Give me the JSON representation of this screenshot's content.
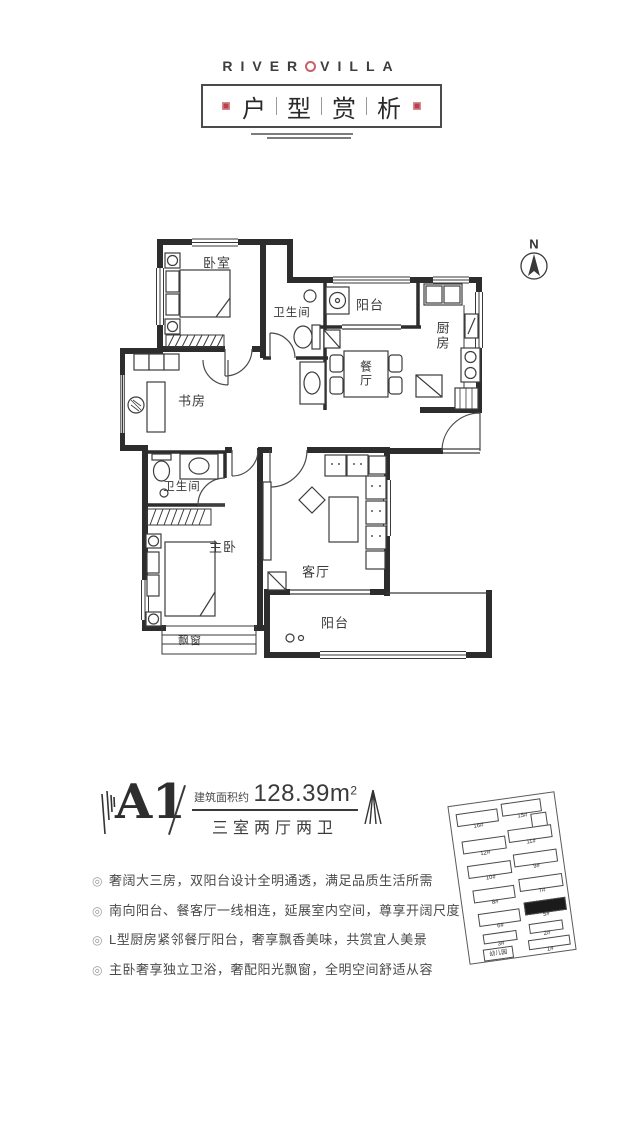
{
  "colors": {
    "accent_red": "#c9606b",
    "seal_red": "#b5434c",
    "wall": "#2d2d2d",
    "text": "#3e3e3e"
  },
  "header": {
    "brand_left": "RIVER",
    "brand_right": "VILLA",
    "title_chars": [
      "户",
      "型",
      "赏",
      "析"
    ]
  },
  "floor_plan": {
    "north_label": "N",
    "rooms": {
      "bedroom": "卧室",
      "bath_top": "卫生间",
      "balcony_top": "阳台",
      "kitchen": "厨房",
      "dining": "餐厅",
      "study": "书房",
      "bath_bottom": "卫生间",
      "master": "主卧",
      "living": "客厅",
      "balcony_bottom": "阳台",
      "bay_window": "飘窗"
    }
  },
  "unit": {
    "name": "A1",
    "area_label": "建筑面积约",
    "area_value": "128.39m",
    "area_sup": "2",
    "layout": "三室两厅两卫"
  },
  "features_bullet": "◎",
  "features": [
    "奢阔大三房，双阳台设计全明通透，满足品质生活所需",
    "南向阳台、餐客厅一线相连，延展室内空间，尊享开阔尺度",
    "L型厨房紧邻餐厅阳台，奢享飘香美味，共赏宜人美景",
    "主卧奢享独立卫浴，奢配阳光飘窗，全明空间舒适从容"
  ],
  "site_plan": {
    "buildings": [
      {
        "label": "16#",
        "x": 6,
        "y": 8,
        "w": 40,
        "h": 11
      },
      {
        "label": "15#",
        "x": 52,
        "y": 4,
        "w": 38,
        "h": 11
      },
      {
        "label": "13#",
        "x": 80,
        "y": 18,
        "w": 14,
        "h": 12
      },
      {
        "label": "12#",
        "x": 8,
        "y": 36,
        "w": 42,
        "h": 11
      },
      {
        "label": "11#",
        "x": 55,
        "y": 31,
        "w": 42,
        "h": 11
      },
      {
        "label": "10#",
        "x": 10,
        "y": 61,
        "w": 42,
        "h": 11
      },
      {
        "label": "9#",
        "x": 57,
        "y": 56,
        "w": 42,
        "h": 11
      },
      {
        "label": "8#",
        "x": 12,
        "y": 86,
        "w": 40,
        "h": 11
      },
      {
        "label": "7#",
        "x": 59,
        "y": 81,
        "w": 42,
        "h": 11
      },
      {
        "label": "6#",
        "x": 14,
        "y": 110,
        "w": 40,
        "h": 11
      },
      {
        "label": "5#",
        "x": 61,
        "y": 105,
        "w": 40,
        "h": 11,
        "hl": true
      },
      {
        "label": "3#",
        "x": 16,
        "y": 131,
        "w": 32,
        "h": 8
      },
      {
        "label": "2#",
        "x": 63,
        "y": 127,
        "w": 32,
        "h": 8
      },
      {
        "label": "幼儿园",
        "x": 14,
        "y": 146,
        "w": 28,
        "h": 10,
        "tag": true
      },
      {
        "label": "1#",
        "x": 60,
        "y": 143,
        "w": 40,
        "h": 8
      }
    ]
  }
}
